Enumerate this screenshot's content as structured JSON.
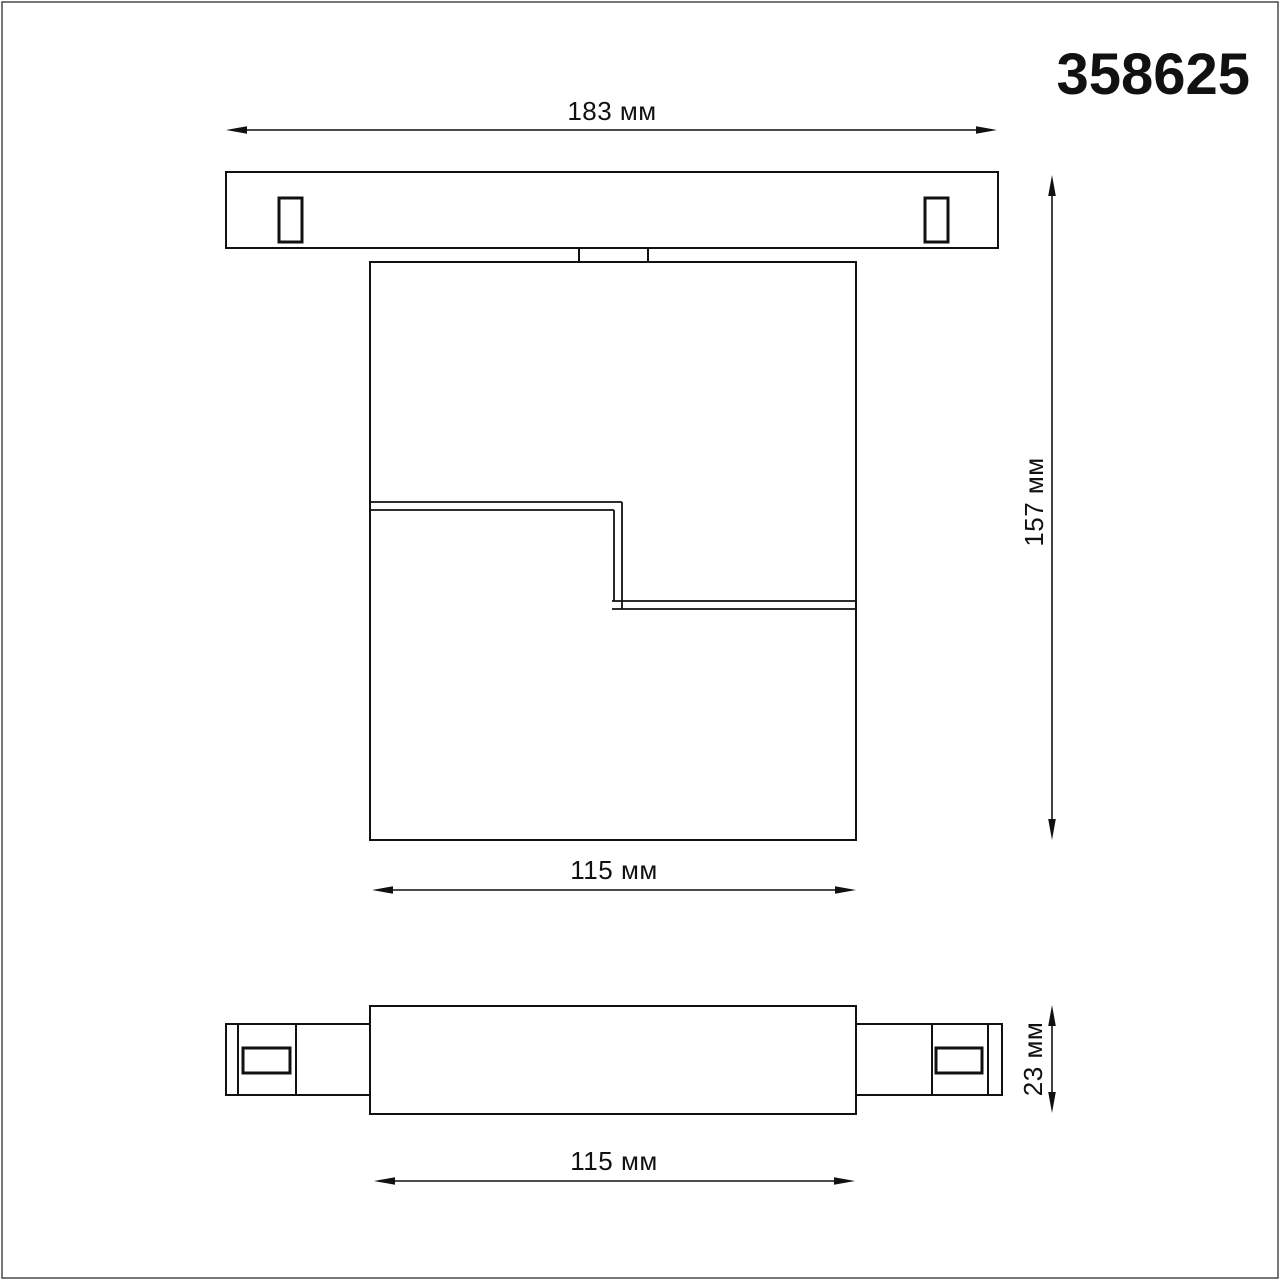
{
  "page": {
    "part_number": "358625",
    "colors": {
      "line": "#111111",
      "background": "#ffffff",
      "border": "#4a4a4a"
    }
  },
  "drawing": {
    "dimensions": {
      "track_width": "183 мм",
      "overall_height": "157 мм",
      "body_width": "115 мм",
      "body_thickness": "23 мм",
      "body_width_bottom": "115 мм"
    }
  }
}
